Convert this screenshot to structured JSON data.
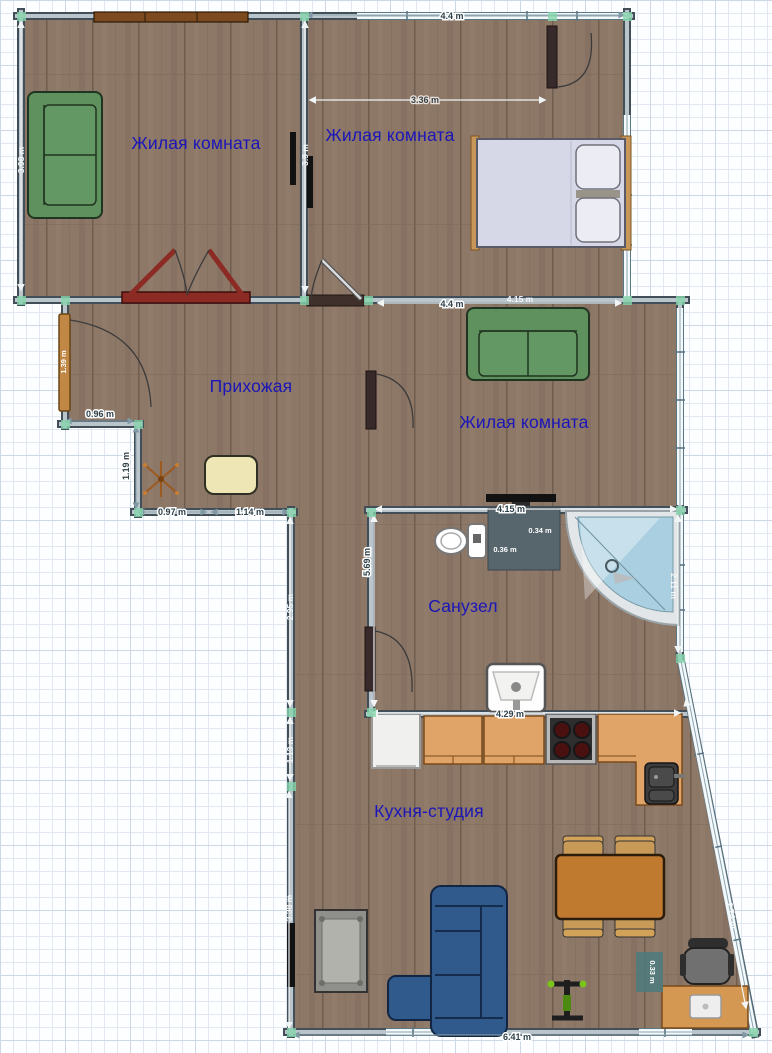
{
  "rooms": [
    {
      "id": "living-room-1",
      "label": "Жилая комната"
    },
    {
      "id": "living-room-2",
      "label": "Жилая комната"
    },
    {
      "id": "living-room-3",
      "label": "Жилая комната"
    },
    {
      "id": "hallway",
      "label": "Прихожая"
    },
    {
      "id": "bathroom",
      "label": "Санузел"
    },
    {
      "id": "kitchen-studio",
      "label": "Кухня-студия"
    }
  ],
  "dimensions": {
    "top_width": "4.4 m",
    "bedroom_width": "3.36 m",
    "room1_height": "3.98 m",
    "divider_height": "3.9 m",
    "room3_width": "4.4 m",
    "bedroom_wall": "4.15 m",
    "hall_step_width": "0.96 m",
    "hall_step_height": "1.19 m",
    "hall_bottom_left": "0.97 m",
    "hall_bottom_right": "1.14 m",
    "hall_right_height": "5.69 m",
    "entrance_door": "1.39 m",
    "bath_width": "4.15 m",
    "bath_shelf_width": "0.34 m",
    "bath_shelf_depth": "0.36 m",
    "bath_right_height": "2.11 m",
    "corridor_height": "2.95 m",
    "kitchen_left_upper": "1.13 m",
    "kitchen_left_lower": "3.38 m",
    "kitchen_width": "4.29 m",
    "bottom_width": "6.41 m",
    "diagonal_wall": "2.74 m",
    "desk_offset": "0.33 m"
  },
  "furniture": [
    "green-sofa",
    "wall-shelf",
    "tv",
    "double-bed",
    "pillow",
    "hall-pouf",
    "coat-rack",
    "toilet",
    "corner-shower",
    "bathroom-sink",
    "fridge",
    "kitchen-cabinet",
    "stove",
    "kitchen-sink",
    "counter",
    "dining-table",
    "dining-chair",
    "blue-corner-sofa",
    "coffee-table",
    "exercise-machine",
    "office-chair",
    "desk",
    "laptop"
  ],
  "colors": {
    "floor": "#8d7767",
    "wall_edge": "#434f58",
    "wall_fill": "#b9c4cb",
    "window_fill": "#f4f9fb",
    "room_label": "#1b16b8",
    "dim_dark": "#2f4149",
    "dim_light": "#f2f5f6",
    "sofa_green": "#5f915f",
    "sofa_blue": "#30598c",
    "cabinet_wood": "#e0a468",
    "door_dark": "#38292a",
    "door_red": "#8c2a24",
    "entrance_door": "#c08844",
    "snap_marker": "#86d6ac",
    "shower_glass": "#a9cfe1",
    "dim_badge": "#4f7b7c",
    "bed": "#d6d7e7",
    "table_orange": "#c07a30"
  }
}
